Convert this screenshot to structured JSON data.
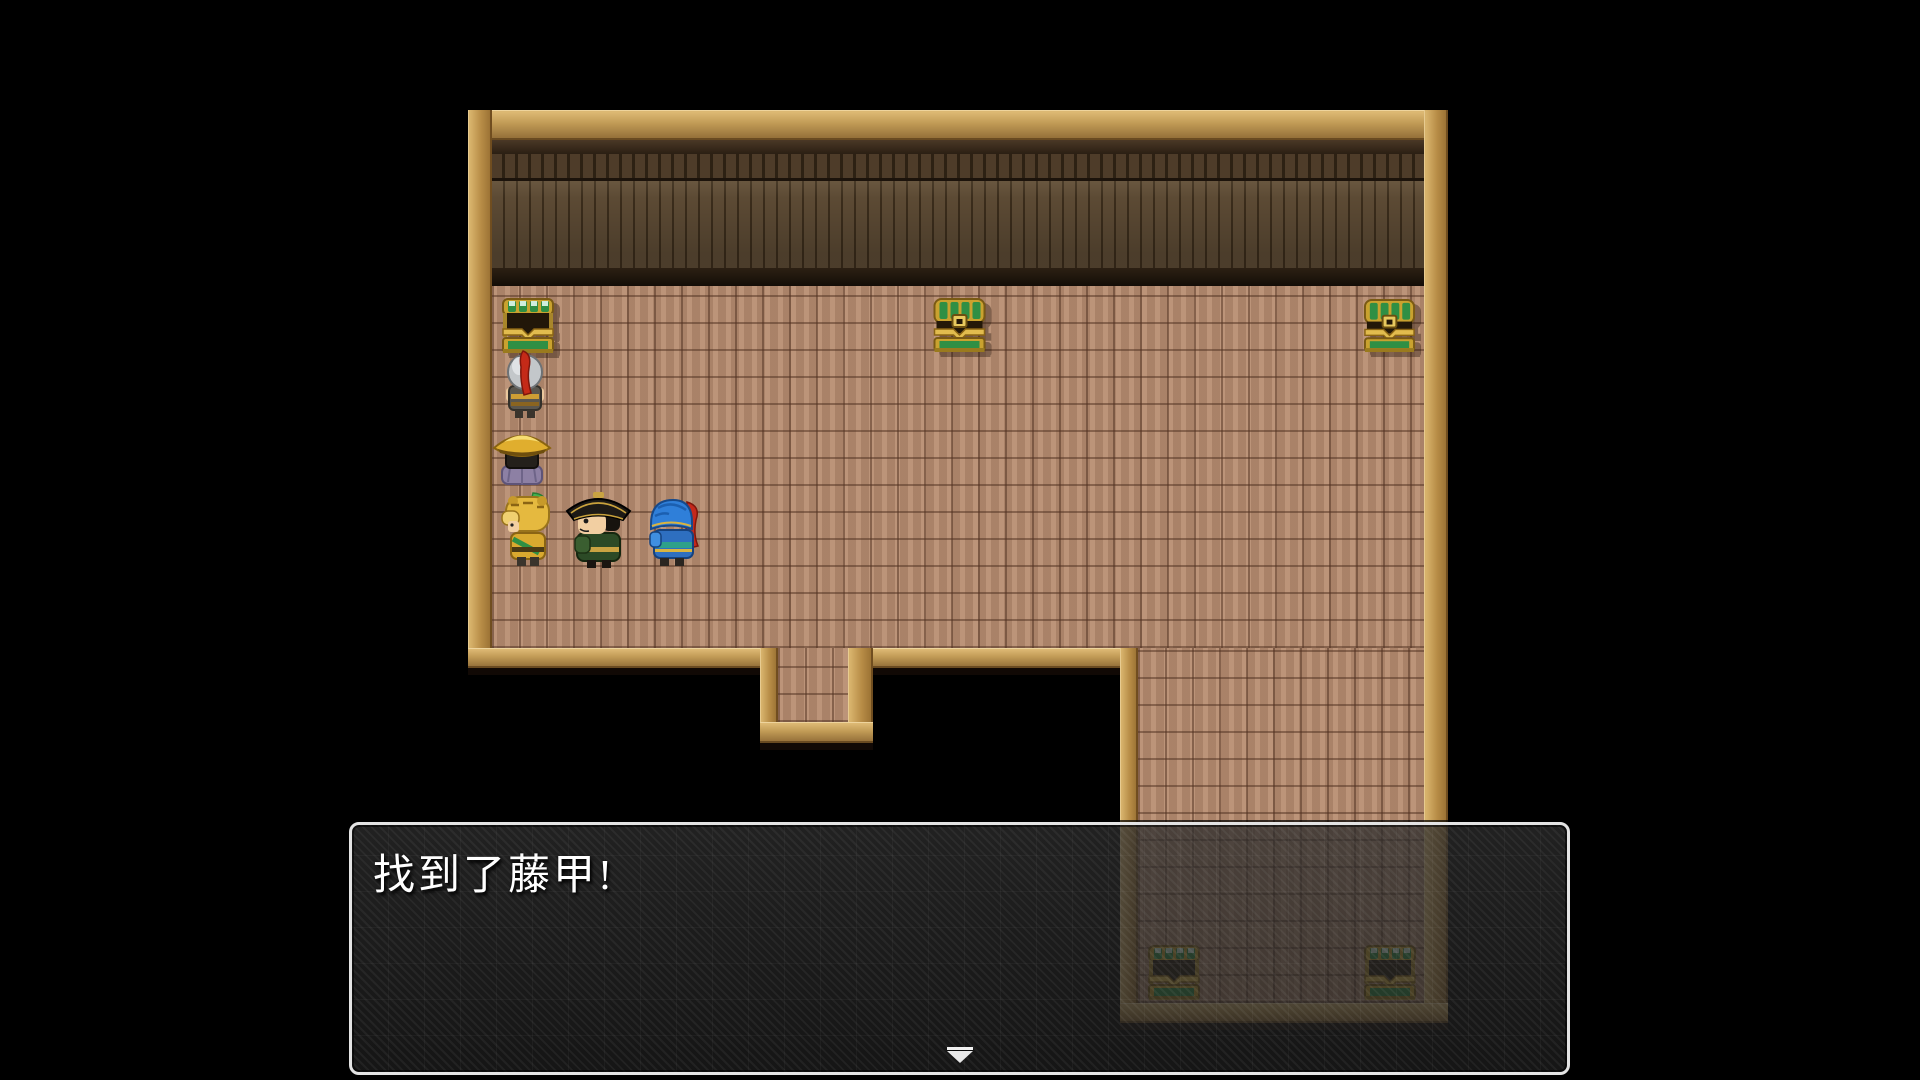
{
  "dialog": {
    "text": "找到了藤甲!",
    "continue_indicator": "pause-arrow-down"
  },
  "scene": {
    "room": "wooden storeroom with parquet floor and plank wall",
    "sprites": [
      {
        "name": "treasure-chest-open",
        "location": "top-left"
      },
      {
        "name": "treasure-chest-closed",
        "location": "top-center"
      },
      {
        "name": "treasure-chest-closed",
        "location": "top-right"
      },
      {
        "name": "treasure-chest-open",
        "location": "lower-right-room-left"
      },
      {
        "name": "treasure-chest-open",
        "location": "lower-right-room-right"
      },
      {
        "name": "knight-silver-helm-red-plume",
        "facing": "up"
      },
      {
        "name": "scholar-gold-hat",
        "facing": "up"
      },
      {
        "name": "warrior-gold-tiger-helm",
        "facing": "left"
      },
      {
        "name": "officer-black-hat-green-robe",
        "facing": "left"
      },
      {
        "name": "warrior-blue-helm-red-plume",
        "facing": "left"
      }
    ]
  },
  "colors": {
    "background": "#000000",
    "floor": "#b48a6e",
    "wall": "#4e3c29",
    "frame": "#c09a55",
    "chest_green": "#2f8f44",
    "chest_gold": "#e2bc4e",
    "window_border": "#e3e3e3",
    "window_background": "rgba(34,34,34,0.76)",
    "text": "#ffffff"
  }
}
